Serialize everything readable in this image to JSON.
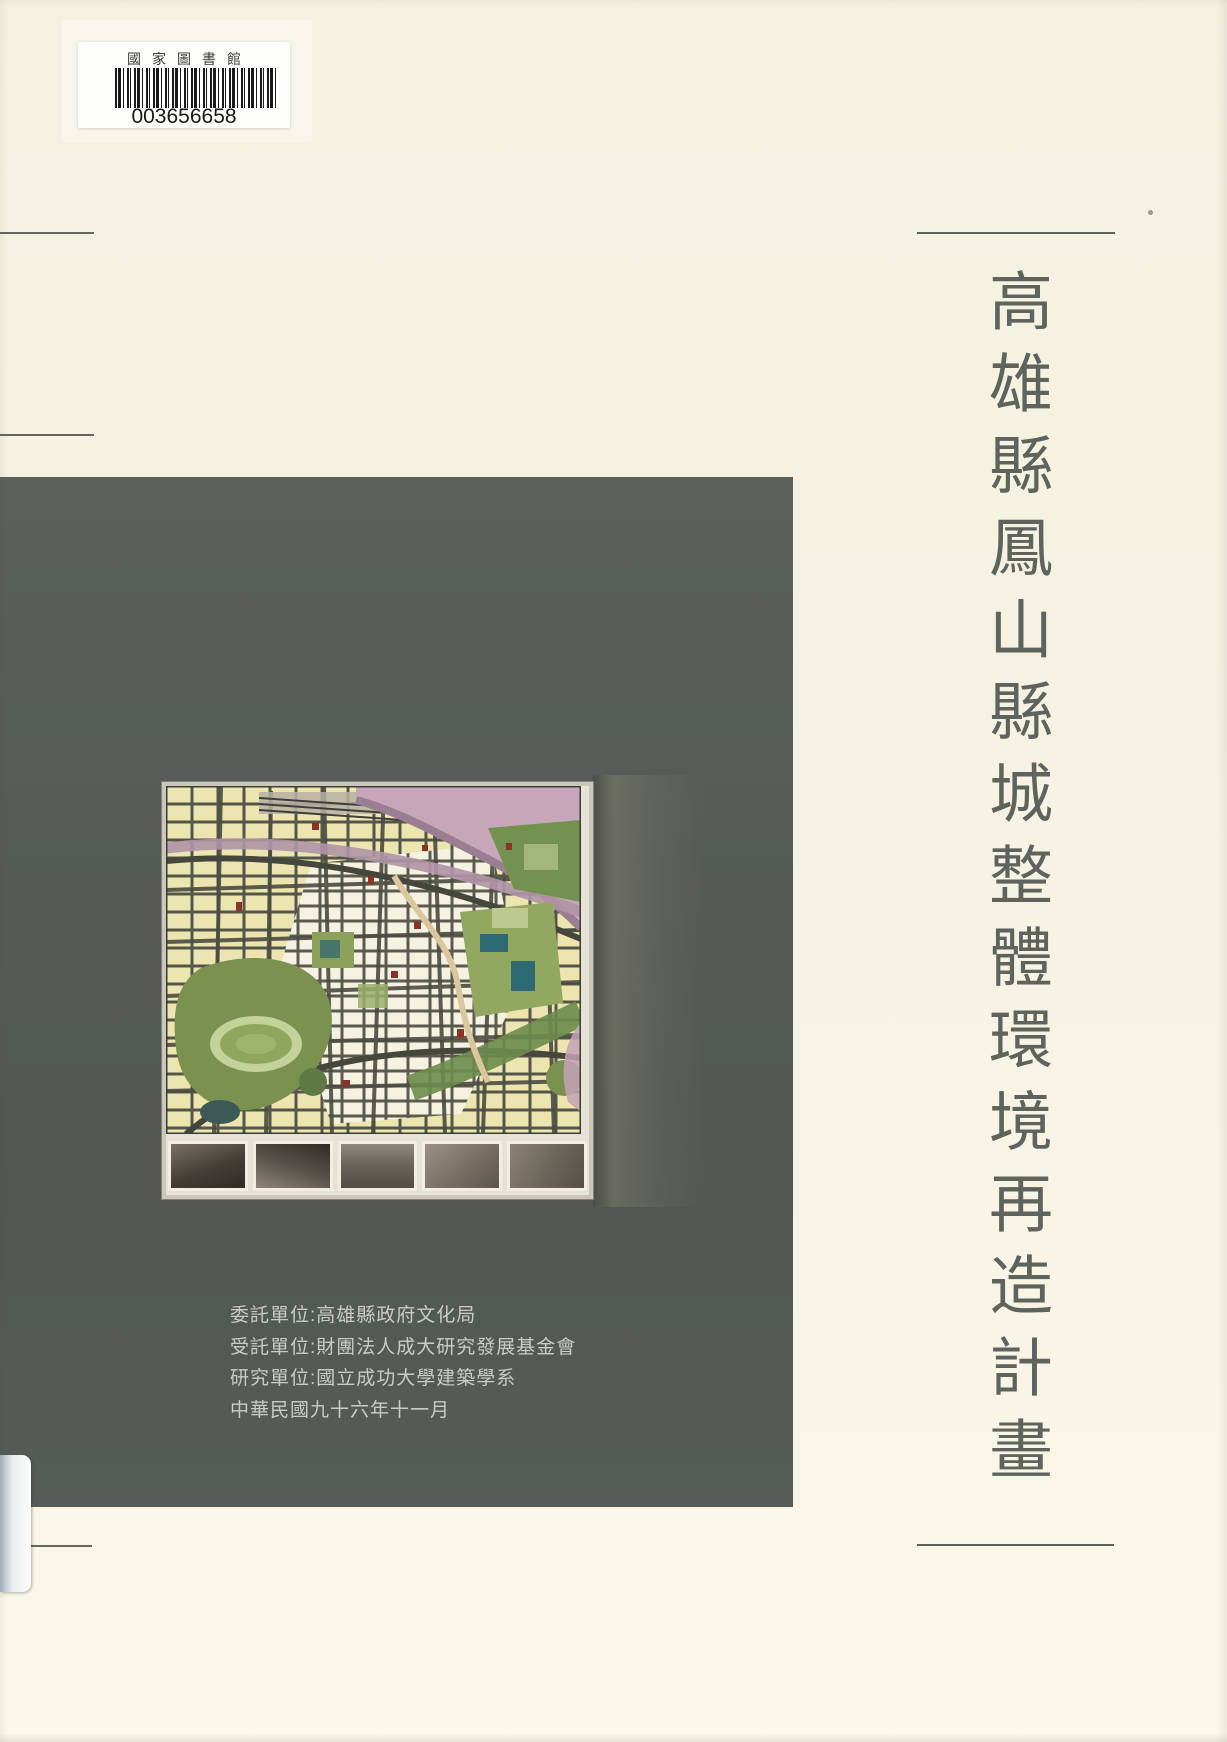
{
  "colors": {
    "page_background": "#f6f3e4",
    "panel": "#555c58",
    "title_text": "#5e635e",
    "credits_text": "#c9ccc5",
    "rule": "#5d625c"
  },
  "library_label": {
    "name": "國家圖書館",
    "barcode_number": "003656658"
  },
  "title": {
    "text": "高雄縣鳳山縣城整體環境再造計畫"
  },
  "credits": {
    "lines": [
      "委託單位:高雄縣政府文化局",
      "受託單位:財團法人成大研究發展基金會",
      "研究單位:國立成功大學建築學系",
      "中華民國九十六年十一月"
    ]
  }
}
